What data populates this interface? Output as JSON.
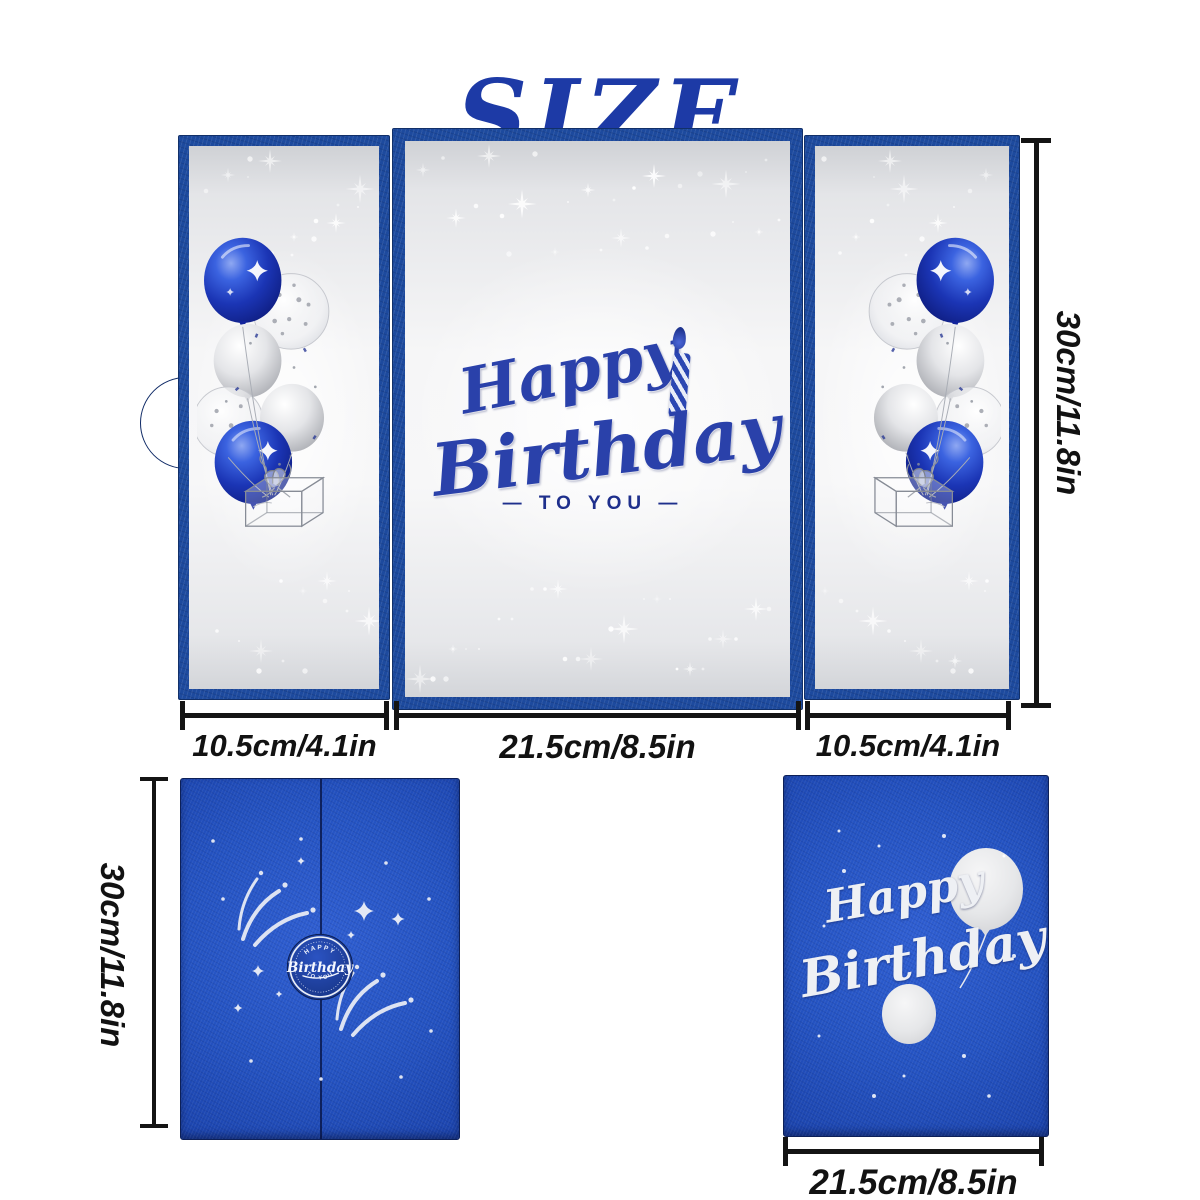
{
  "title": "SIZE",
  "colors": {
    "title_blue": "#1d3aa6",
    "frame_blue": "#1d4a9e",
    "card_blue": "#2453c2",
    "panel_silver": "#eceded",
    "artwork_blue": "#2a41aa",
    "balloon_blue": "#1b35b5",
    "balloon_silver": "#d9dadd",
    "dimension_black": "#141414",
    "white": "#ffffff"
  },
  "open_card": {
    "artwork": {
      "word1": "Happy",
      "word2": "Birthday",
      "subtitle": "— TO YOU —"
    },
    "dim_left": "10.5cm/4.1in",
    "dim_middle": "21.5cm/8.5in",
    "dim_right": "10.5cm/4.1in",
    "dim_height": "30cm/11.8in"
  },
  "front_card": {
    "badge_top": "HAPPY",
    "badge_middle": "Birthday",
    "badge_bottom": "TO YOU",
    "dim_height": "30cm/11.8in"
  },
  "back_card": {
    "word1": "Happy",
    "word2": "Birthday",
    "dim_width": "21.5cm/8.5in"
  }
}
